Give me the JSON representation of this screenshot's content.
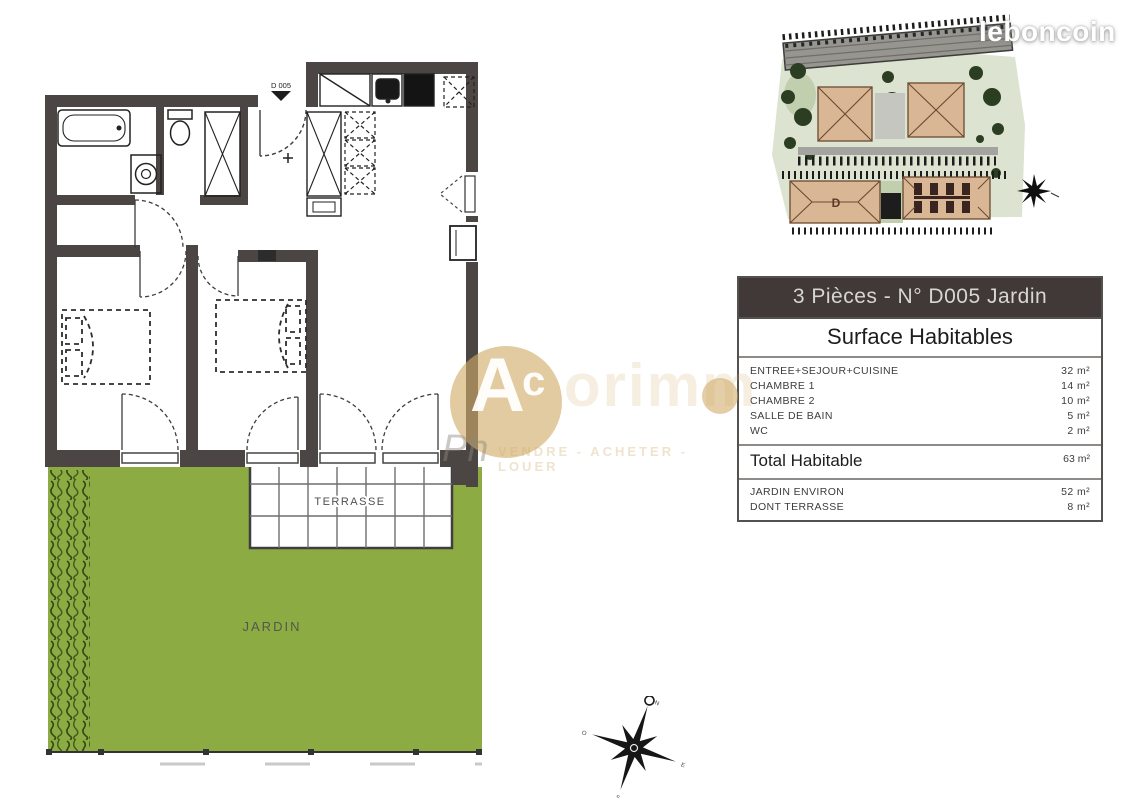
{
  "branding": {
    "logo": "leboncoin"
  },
  "table": {
    "title": "3 Pièces -  N° D005 Jardin",
    "subtitle": "Surface Habitables",
    "rows": [
      {
        "label": "ENTREE+SEJOUR+CUISINE",
        "value": "32 m²"
      },
      {
        "label": "CHAMBRE 1",
        "value": "14 m²"
      },
      {
        "label": "CHAMBRE 2",
        "value": "10 m²"
      },
      {
        "label": "SALLE DE BAIN",
        "value": "5 m²"
      },
      {
        "label": "WC",
        "value": "2 m²"
      }
    ],
    "total": {
      "label": "Total Habitable",
      "value": "63 m²"
    },
    "extras": [
      {
        "label": "JARDIN ENVIRON",
        "value": "52 m²"
      },
      {
        "label": "DONT TERRASSE",
        "value": "8 m²"
      }
    ]
  },
  "floor_plan": {
    "entrance_label": "D 005",
    "terrace_label": "TERRASSE",
    "garden_label": "JARDIN"
  },
  "site_plan": {
    "building_d_label": "D"
  },
  "compass": {
    "north": "N",
    "south": "S",
    "east": "E",
    "west": "O"
  },
  "watermark": {
    "letter_a": "A",
    "letter_c": "c",
    "fragment": "orimm",
    "ph": "Ph",
    "tagline": "VENDRE - ACHETER - LOUER"
  },
  "colors": {
    "wall": "#4b4644",
    "garden_green": "#8cab42",
    "hedge_green": "#2f4a16",
    "roof_tan": "#d9b795",
    "table_header_bg": "#403937",
    "watermark_gold": "#d1ab67"
  }
}
